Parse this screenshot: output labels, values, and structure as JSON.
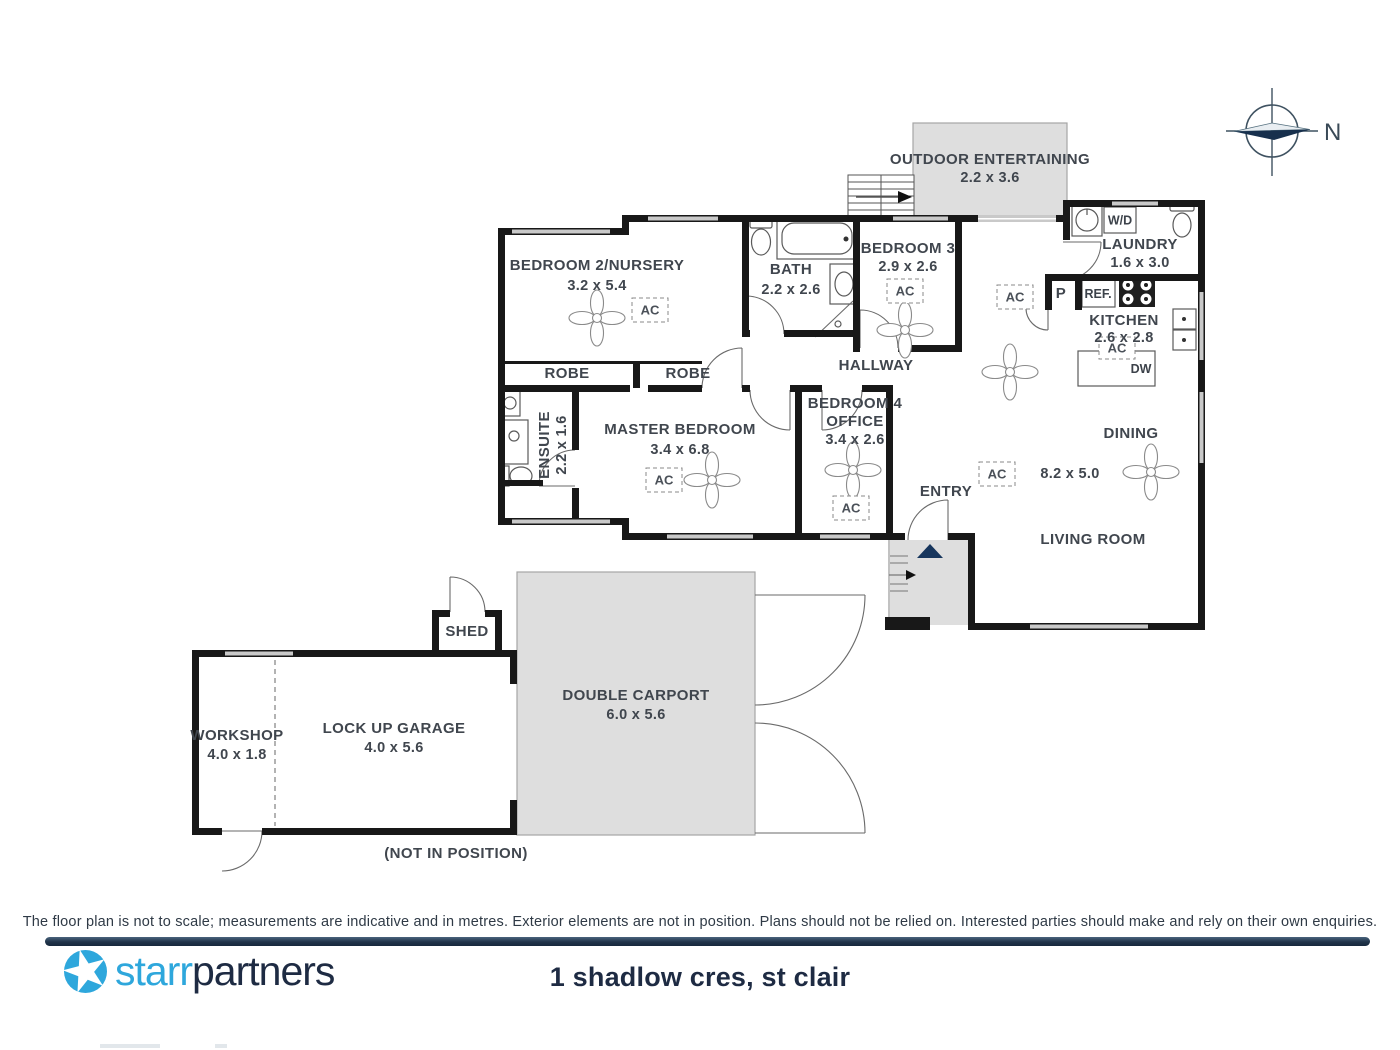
{
  "address": "1 shadlow cres, st clair",
  "brand": {
    "word1": "starr",
    "word2": "partners"
  },
  "disclaimer": "The floor plan is not to scale; measurements are indicative and in metres. Exterior elements are not in position. Plans should not be relied on. Interested parties should make and rely on their own enquiries.",
  "compass": {
    "north": "N"
  },
  "notes": {
    "not_in_position": "(NOT IN POSITION)"
  },
  "rooms": {
    "outdoor_entertaining": {
      "name": "OUTDOOR ENTERTAINING",
      "dims": "2.2 x 3.6"
    },
    "bedroom2": {
      "name": "BEDROOM 2/NURSERY",
      "dims": "3.2 x 5.4"
    },
    "bath": {
      "name": "BATH",
      "dims": "2.2 x 2.6"
    },
    "bedroom3": {
      "name": "BEDROOM 3",
      "dims": "2.9 x 2.6"
    },
    "laundry": {
      "name": "LAUNDRY",
      "dims": "1.6 x 3.0"
    },
    "kitchen": {
      "name": "KITCHEN",
      "dims": "2.6 x 2.8"
    },
    "hallway": {
      "name": "HALLWAY"
    },
    "robe_left": {
      "name": "ROBE"
    },
    "robe_right": {
      "name": "ROBE"
    },
    "ensuite": {
      "name": "ENSUITE",
      "dims": "2.2 x 1.6"
    },
    "master_bedroom": {
      "name": "MASTER BEDROOM",
      "dims": "3.4 x 6.8"
    },
    "bedroom4": {
      "name": "BEDROOM 4",
      "name2": "OFFICE",
      "dims": "3.4 x 2.6"
    },
    "entry": {
      "name": "ENTRY"
    },
    "dining": {
      "name": "DINING"
    },
    "living_room": {
      "name": "LIVING ROOM"
    },
    "living_dining_dims": "8.2 x 5.0",
    "shed": {
      "name": "SHED"
    },
    "workshop": {
      "name": "WORKSHOP",
      "dims": "4.0 x 1.8"
    },
    "garage": {
      "name": "LOCK UP GARAGE",
      "dims": "4.0 x 5.6"
    },
    "carport": {
      "name": "DOUBLE CARPORT",
      "dims": "6.0 x 5.6"
    }
  },
  "labels": {
    "ac": "AC",
    "wd": "W/D",
    "pantry": "P",
    "fridge": "REF.",
    "dishwasher": "DW"
  },
  "colors": {
    "accent_blue": "#2ea7dc",
    "navy": "#1e2b43",
    "wall": "#181818",
    "shade_fill": "#dedede",
    "entry_marker": "#17365d",
    "footer_bar": "#1d3044"
  }
}
